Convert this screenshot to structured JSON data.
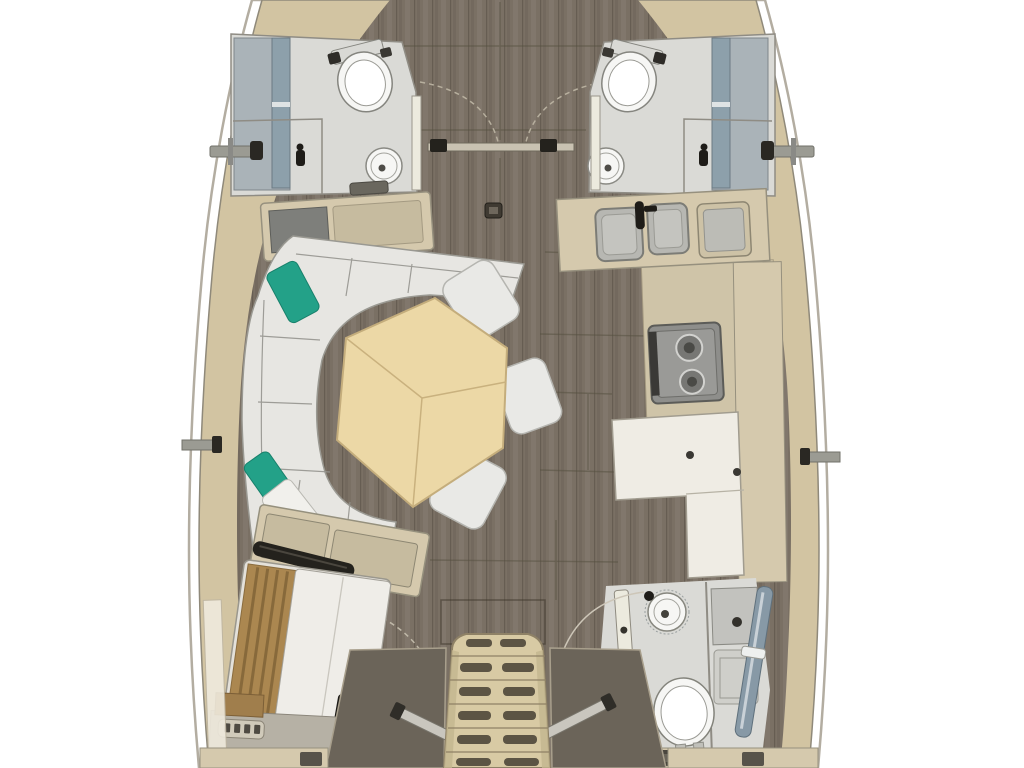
{
  "diagram": {
    "kind": "yacht-interior-floor-plan",
    "orientation": "bow-up",
    "visible_text": ""
  },
  "palette": {
    "background": "#ffffff",
    "hull_band": "#d2c4a2",
    "hull_line": "#8f897a",
    "rub_line": "#b3ada1",
    "floor_wood": "#7a7064",
    "floor_seam": "#55503f",
    "head_floor": "#dadad6",
    "vanity_gray": "#aab3b8",
    "window_glass": "#8da0ab",
    "porcelain": "#f6f6f4",
    "fixture_line": "#85857f",
    "furniture_beige": "#d5c9ad",
    "panel_beige": "#c6bb9f",
    "furniture_line": "#95907d",
    "sole_beige": "#cfc4a8",
    "sofa": "#e7e6e2",
    "pillow_teal": "#23a188",
    "pillow_white": "#f1f0ec",
    "table_wood": "#ecd8a6",
    "table_line": "#c4ad7c",
    "stool": "#e9e9e6",
    "stove_body": "#8e8e8b",
    "stove_dark": "#3a3936",
    "sink_gray": "#b7b7b2",
    "seat_white": "#efece4",
    "rail_black": "#24221d",
    "glass_door": "#8799a6",
    "stairs": "#d8caa4",
    "stair_slot": "#5c5444",
    "wedge": "#6b6459",
    "mattress": "#efede8",
    "headboard": "#ab8750",
    "door_leaf": "#eceade",
    "metal_gray": "#9b9b93",
    "knob_black": "#2a2823",
    "arc_line": "#bfb8a8",
    "trim_white": "#efeadd"
  },
  "elements": {
    "hull": "sailboat hull, bow up, cropped top and bottom",
    "forward_port_head": "bathroom with toilet and round sink, port bow",
    "forward_starboard_head": "bathroom with toilet and round sink, starboard bow",
    "bow_doors": "double cabin doors with swing arcs",
    "salon_sofa": "L-shaped settee with two teal pillows and one white pillow",
    "sideboard": "cabinet with dark panel forward of settee",
    "dining_table": "hexagonal wood saloon table with three leaf seams",
    "stools": "three white movable stools around table",
    "galley": "L-shaped galley: double sink, second basin, two-burner stove",
    "nav_seat": "L-shaped chart table / seat on starboard side",
    "aft_port_cabin": "aft cabin with double berth and wood headboard",
    "aft_starboard_head": "aft bathroom with round sink, toilet and glass shower door",
    "companionway": "companionway ladder with grooved steps, flanked by engine panels and handrails"
  }
}
